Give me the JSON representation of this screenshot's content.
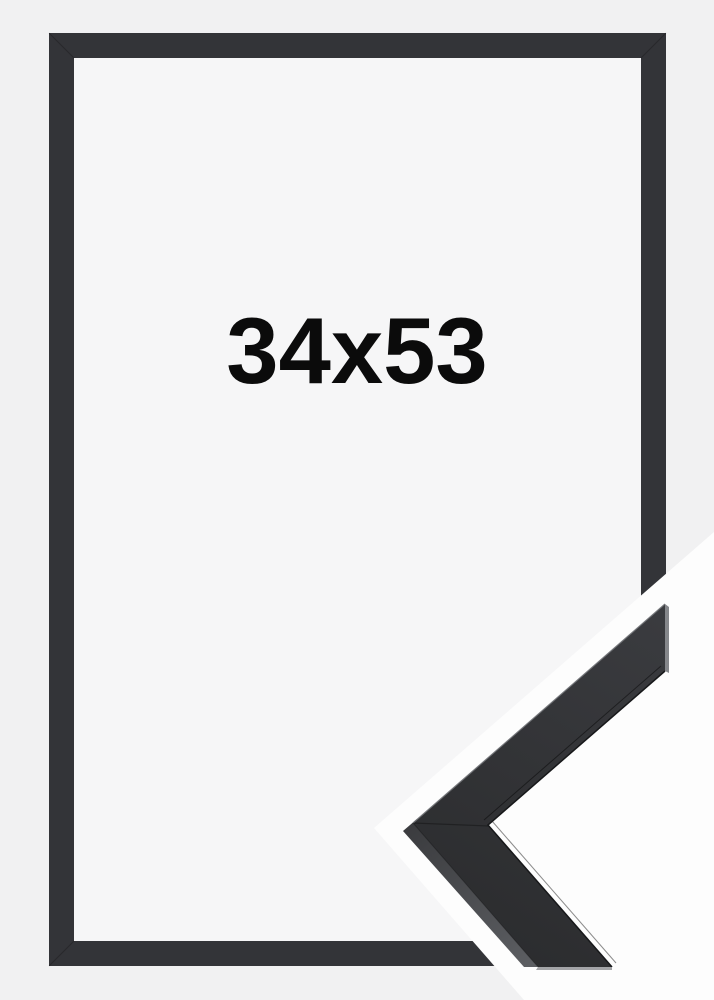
{
  "product": {
    "size_label": "34x53"
  },
  "colors": {
    "background": "#f1f1f2",
    "inner_panel": "#f6f6f7",
    "frame": "#333438",
    "halo_white": "#fdfdfd",
    "label_text": "#0b0b0b",
    "sample_face_dark": "#2a2b2d",
    "sample_face_light": "#3b3c40",
    "sample_bevel_dark": "#3b3c3f",
    "sample_bevel_light": "#5d5f63",
    "sample_tip_edge": "#85878b",
    "sample_bottom_edge": "#a3a4a7",
    "sample_highlight": "#6f7175"
  }
}
